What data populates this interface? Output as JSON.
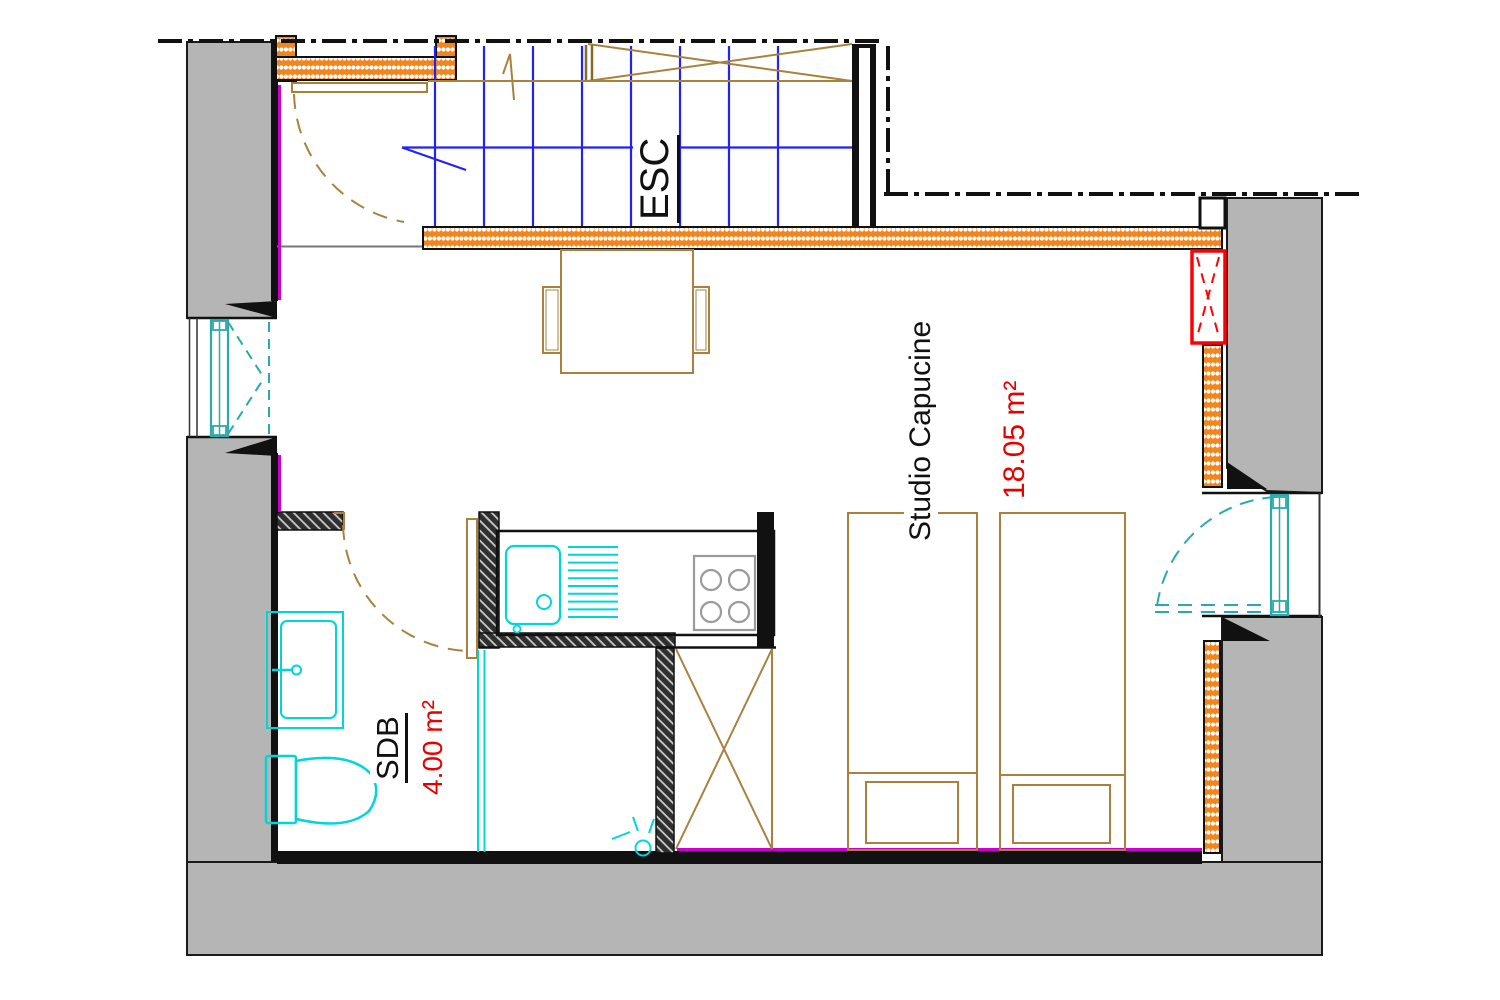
{
  "page": {
    "title": "Plan d'étage — Studio Capucine",
    "type": "floor-plan"
  },
  "rooms": {
    "stairs": {
      "label": "ESC"
    },
    "bathroom": {
      "label": "SDB",
      "area": "4.00 m²"
    },
    "studio": {
      "label": "Studio Capucine",
      "area": "18.05 m²"
    }
  },
  "colors": {
    "wall_gray": "#b5b5b5",
    "insulation_orange": "#f2861d",
    "partition_dark": "#2f2f2f",
    "stairs_blue": "#2222f5",
    "wood_tan": "#a8823d",
    "fixture_cyan": "#00d6d6",
    "window_teal": "#2aabab",
    "accent_red": "#ff0000",
    "accent_magenta": "#cc00cc",
    "line_black": "#111111"
  }
}
